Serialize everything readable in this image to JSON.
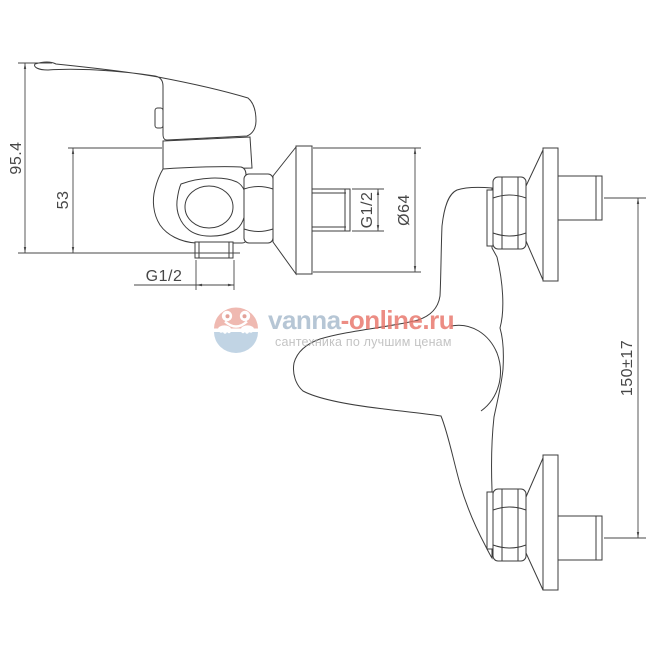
{
  "drawing": {
    "side_view": {
      "dim_total_height": "95.4",
      "dim_body_height": "53",
      "dim_outlet_thread": "G1/2",
      "dim_inlet_thread": "G1/2",
      "dim_flange_diameter": "Ø64"
    },
    "front_view": {
      "dim_centers_distance": "150±17"
    }
  },
  "watermark": {
    "brand_primary": "vanna",
    "brand_secondary": "-online.ru",
    "tagline": "сантехника по лучшим ценам",
    "colors": {
      "brand_primary": "#a7bacc",
      "brand_secondary": "#e8756a",
      "tagline": "#b7b7b7",
      "logo_top": "#ecaaa0",
      "logo_bottom": "#b4cbdf",
      "line": "#3c3c3c"
    }
  }
}
